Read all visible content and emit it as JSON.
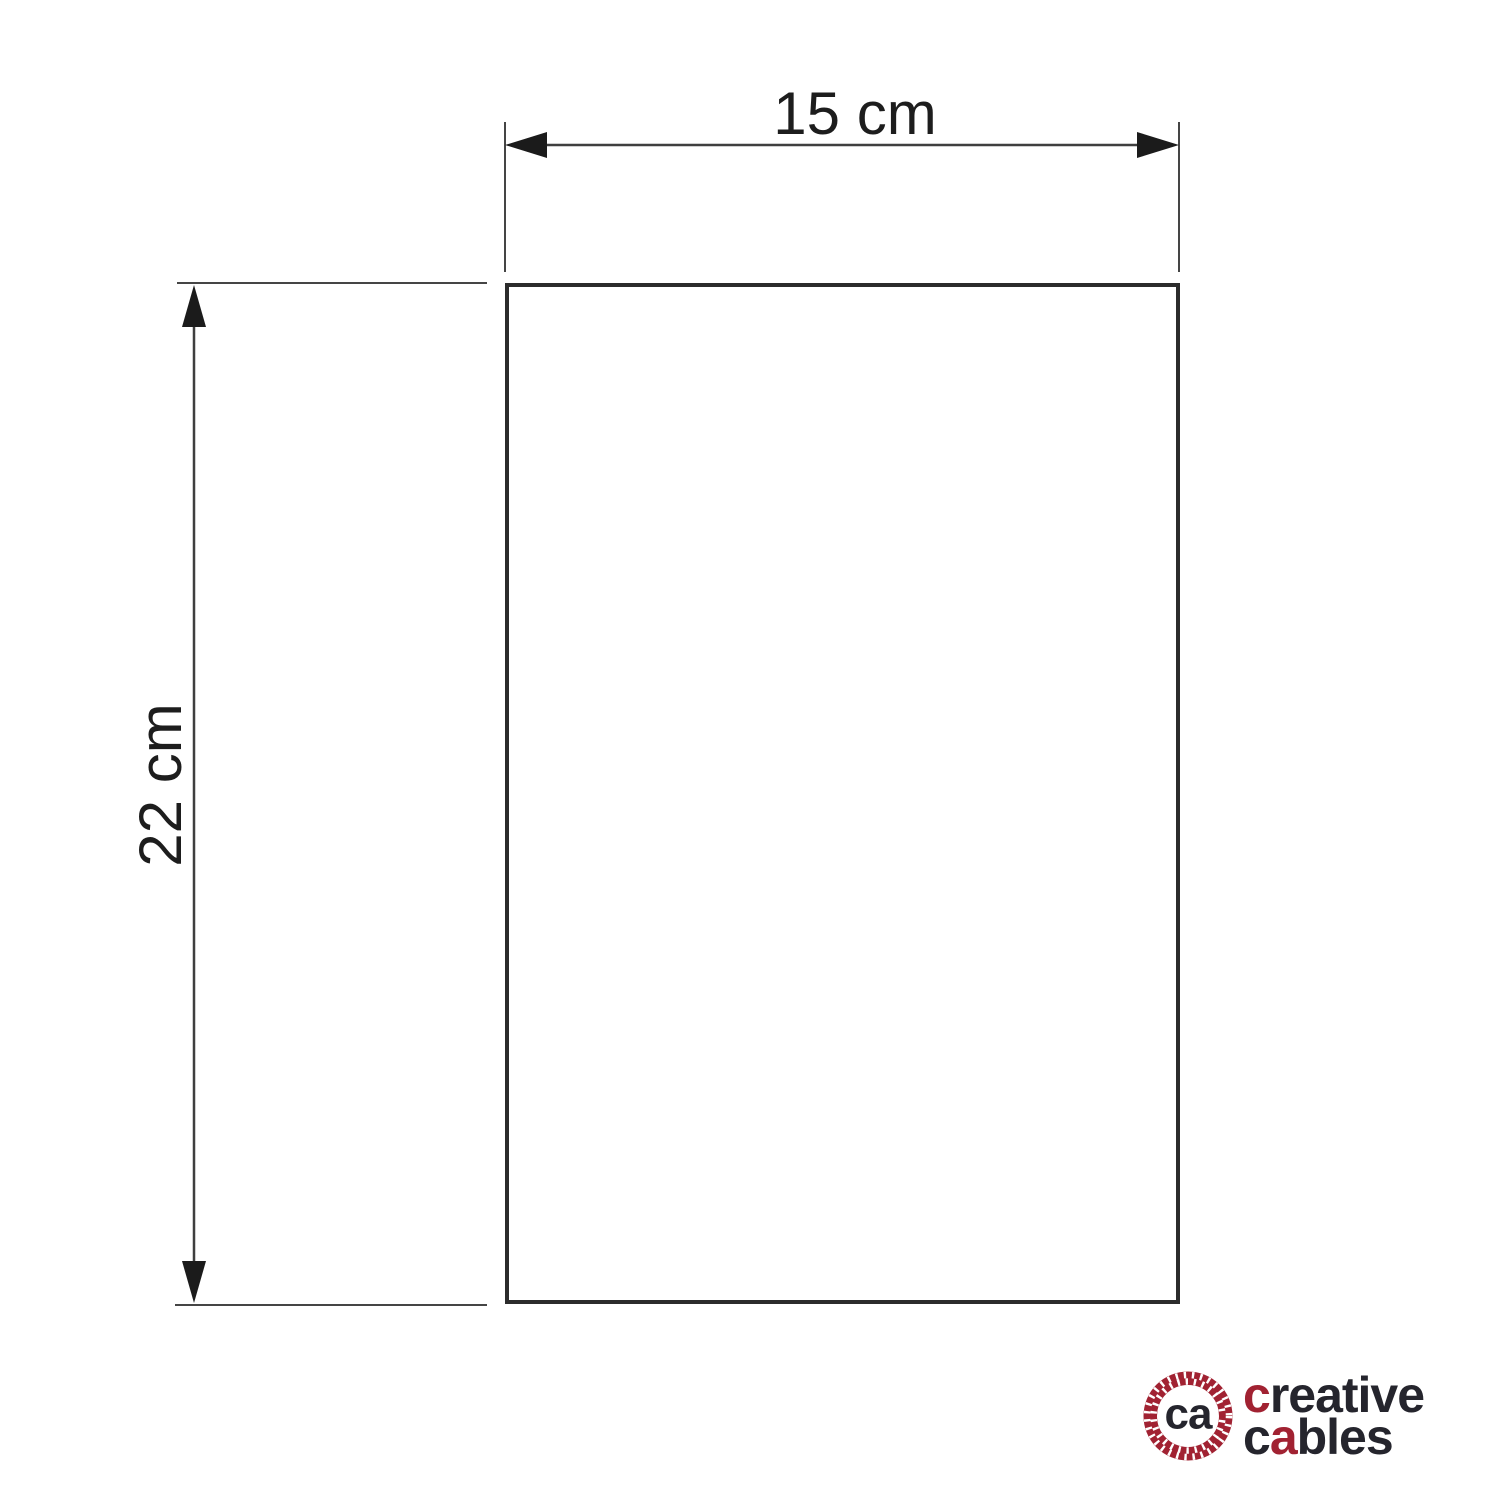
{
  "diagram": {
    "width_label": "15 cm",
    "height_label": "22 cm"
  },
  "logo": {
    "monogram": "ca",
    "line1_initial": "c",
    "line1_rest": "reative",
    "line2_initial": "c",
    "line2_accent": "a",
    "line2_rest": "bles",
    "brand_red": "#a12232",
    "text_dark": "#25252d"
  }
}
